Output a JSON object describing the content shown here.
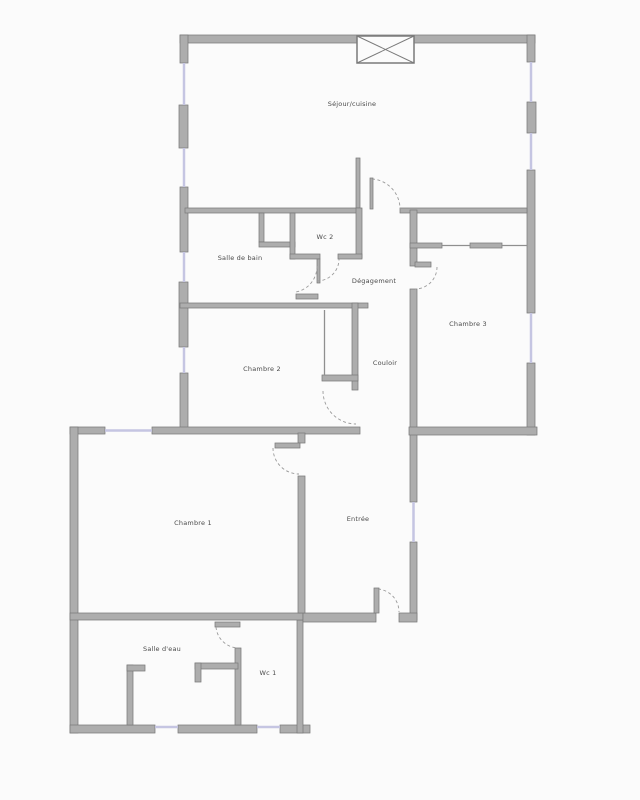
{
  "floorplan": {
    "rooms": [
      {
        "id": "sejour-cuisine",
        "label": "Séjour/cuisine"
      },
      {
        "id": "salle-de-bain",
        "label": "Salle de bain"
      },
      {
        "id": "wc-2",
        "label": "Wc 2"
      },
      {
        "id": "degagement",
        "label": "Dégagement"
      },
      {
        "id": "chambre-3",
        "label": "Chambre 3"
      },
      {
        "id": "chambre-2",
        "label": "Chambre 2"
      },
      {
        "id": "couloir",
        "label": "Couloir"
      },
      {
        "id": "chambre-1",
        "label": "Chambre 1"
      },
      {
        "id": "entree",
        "label": "Entrée"
      },
      {
        "id": "salle-d-eau",
        "label": "Salle d'eau"
      },
      {
        "id": "wc-1",
        "label": "Wc 1"
      }
    ],
    "colors": {
      "wall": "#adadad",
      "wall_edge": "#7a7a7a",
      "window": "#c5c5e2",
      "background": "#fbfbfb",
      "label_text": "#4a4a4a"
    }
  }
}
